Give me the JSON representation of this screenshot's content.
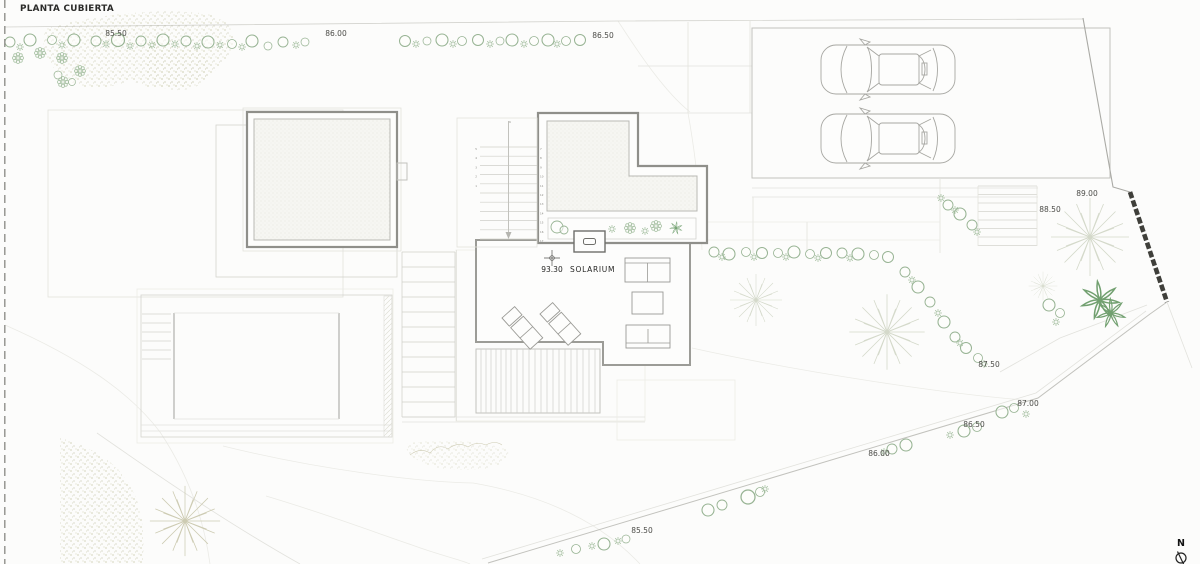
{
  "title": "PLANTA CUBIERTA",
  "north_label": "N",
  "solarium": {
    "level": "93.30",
    "name": "SOLARIUM"
  },
  "elevation_labels": [
    {
      "text": "85.50"
    },
    {
      "text": "86.00"
    },
    {
      "text": "86.50"
    },
    {
      "text": "89.00"
    },
    {
      "text": "88.50"
    },
    {
      "text": "87.50"
    },
    {
      "text": "87.00"
    },
    {
      "text": "86.50"
    },
    {
      "text": "86.00"
    },
    {
      "text": "85.50"
    }
  ],
  "stairs": {
    "left": [
      "5",
      "4",
      "3",
      "2",
      "1"
    ],
    "top": "6",
    "right": [
      "7",
      "8",
      "9",
      "10",
      "11",
      "12",
      "13",
      "14",
      "15",
      "16",
      "17"
    ]
  },
  "colors": {
    "paper": "#fcfcfb",
    "structure": "#8f8f8a",
    "vegetation": "#97b393",
    "speckle": "#b0b084",
    "retaining_wall": "#3f3f3a",
    "label_text": "#4c4c48"
  }
}
